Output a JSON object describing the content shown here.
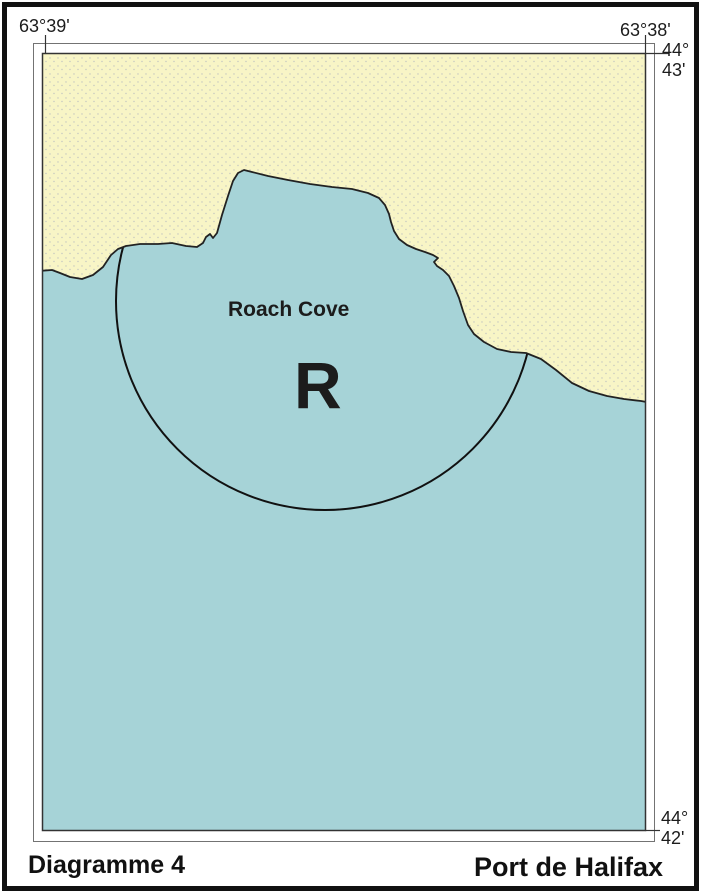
{
  "page": {
    "caption_left": "Diagramme 4",
    "caption_right": "Port de Halifax"
  },
  "map": {
    "labels": {
      "lon_left": "63°39'",
      "lon_right": "63°38'",
      "lat_top_deg": "44°",
      "lat_top_min": "43'",
      "lat_bottom_deg": "44°",
      "lat_bottom_min": "42'"
    },
    "features": {
      "cove_name": "Roach Cove",
      "restricted_area_letter": "R"
    },
    "colors": {
      "land": "#f8f5c6",
      "water": "#a6d3d7",
      "line": "#1f1f1f"
    }
  }
}
